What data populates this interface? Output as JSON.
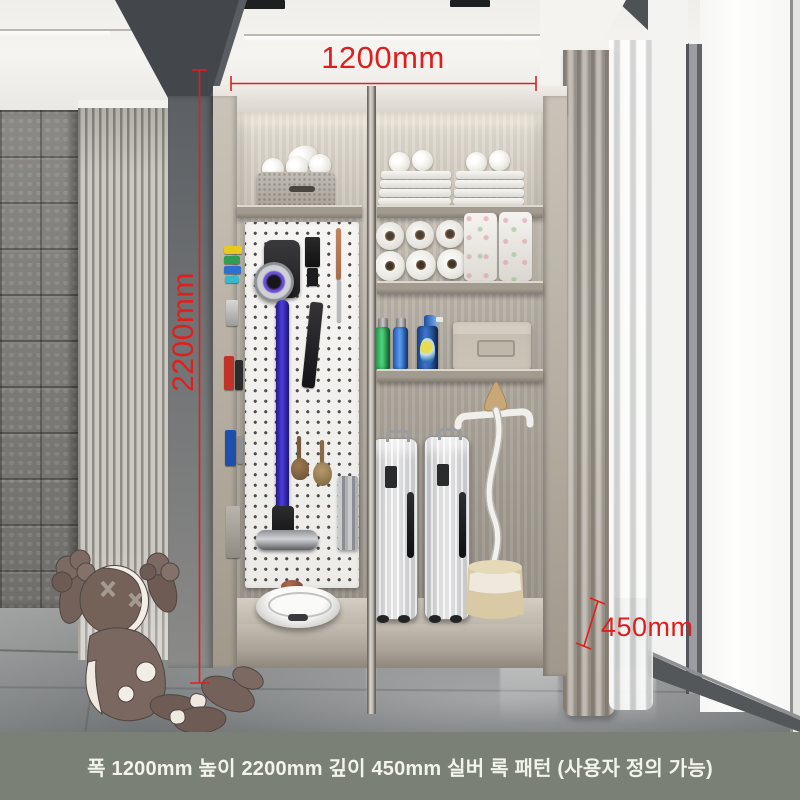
{
  "annotations": {
    "width_label": "1200mm",
    "height_label": "2200mm",
    "depth_label": "450mm"
  },
  "caption": {
    "text": "폭 1200mm 높이 2200mm 깊이 450mm 실버 록 패턴 (사용자 정의 가능)"
  },
  "colors": {
    "dimension_red": "#e01f1c",
    "caption_bg": "#7a8076",
    "caption_text": "#f2f3ec",
    "cabinet_wood": "#b9b2a7",
    "vacuum_wand_blue": "#3b2fd0",
    "floor_gray": "#8d8f8f"
  }
}
